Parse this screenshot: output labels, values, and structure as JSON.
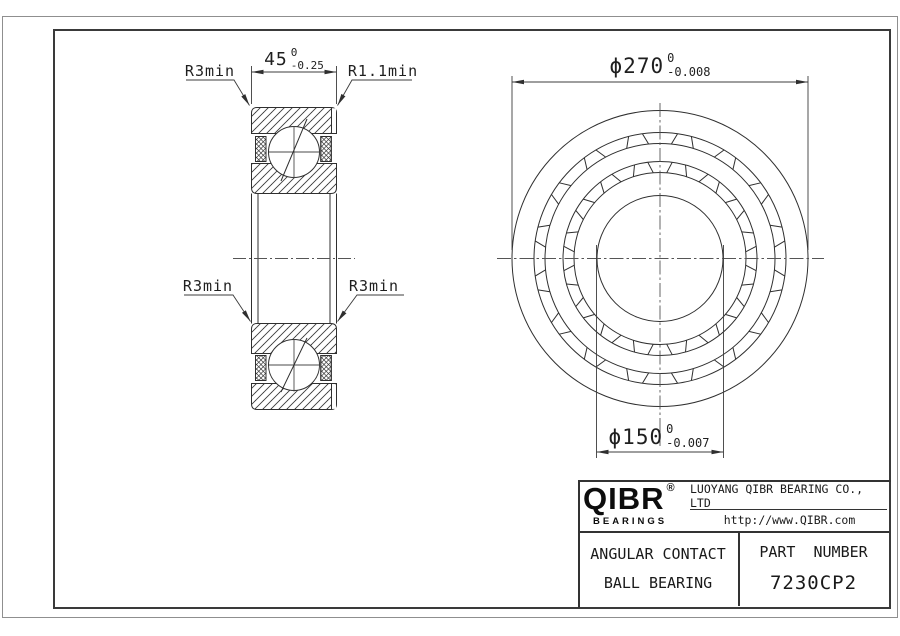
{
  "drawing": {
    "section_view": {
      "label_r3min_top": "R3min",
      "label_r11min": "R1.1min",
      "label_r3min_left": "R3min",
      "label_r3min_right": "R3min",
      "width_dim": {
        "value": "45",
        "tol_upper": "0",
        "tol_lower": "-0.25"
      }
    },
    "front_view": {
      "od_dim": {
        "symbol": "ϕ",
        "value": "270",
        "tol_upper": "0",
        "tol_lower": "-0.008"
      },
      "bore_dim": {
        "symbol": "ϕ",
        "value": "150",
        "tol_upper": "0",
        "tol_lower": "-0.007"
      },
      "circle_radii_px": [
        148,
        126,
        115,
        97,
        86,
        63
      ],
      "pocket_count": 16
    }
  },
  "title_block": {
    "logo": {
      "name": "QIBR",
      "registered": "®",
      "tagline": "BEARINGS"
    },
    "company_name": "LUOYANG QIBR BEARING CO., LTD",
    "website": "http://www.QIBR.com",
    "product_type_line1": "ANGULAR CONTACT",
    "product_type_line2": "BALL BEARING",
    "part_number_label": "PART  NUMBER",
    "part_number": "7230CP2"
  }
}
